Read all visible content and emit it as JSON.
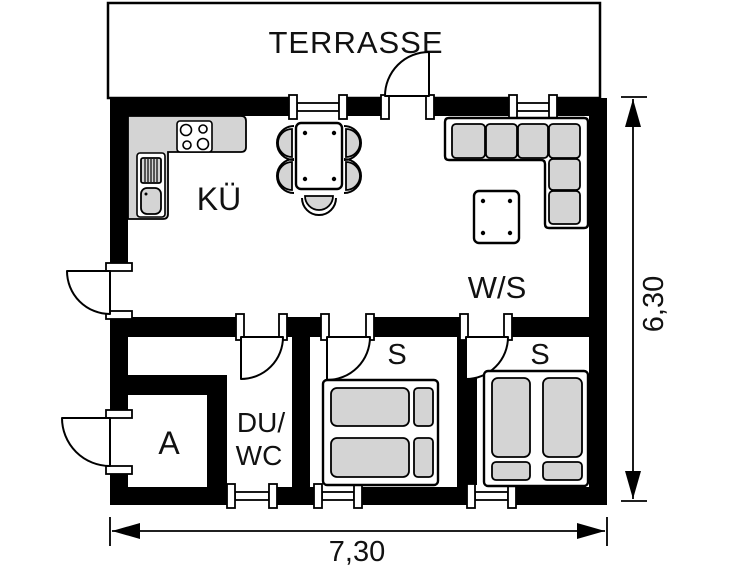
{
  "plan": {
    "terrace_label": "TERRASSE",
    "rooms": {
      "kitchen": "KÜ",
      "living": "W/S",
      "bedroom_mid": "S",
      "bedroom_right": "S",
      "bath_line1": "DU/",
      "bath_line2": "WC",
      "storage": "A"
    },
    "dimensions": {
      "width_label": "7,30",
      "height_label": "6,30"
    },
    "colors": {
      "wall": "#000000",
      "furniture_fill": "#d4d4d4",
      "background": "#ffffff",
      "line": "#000000"
    }
  }
}
